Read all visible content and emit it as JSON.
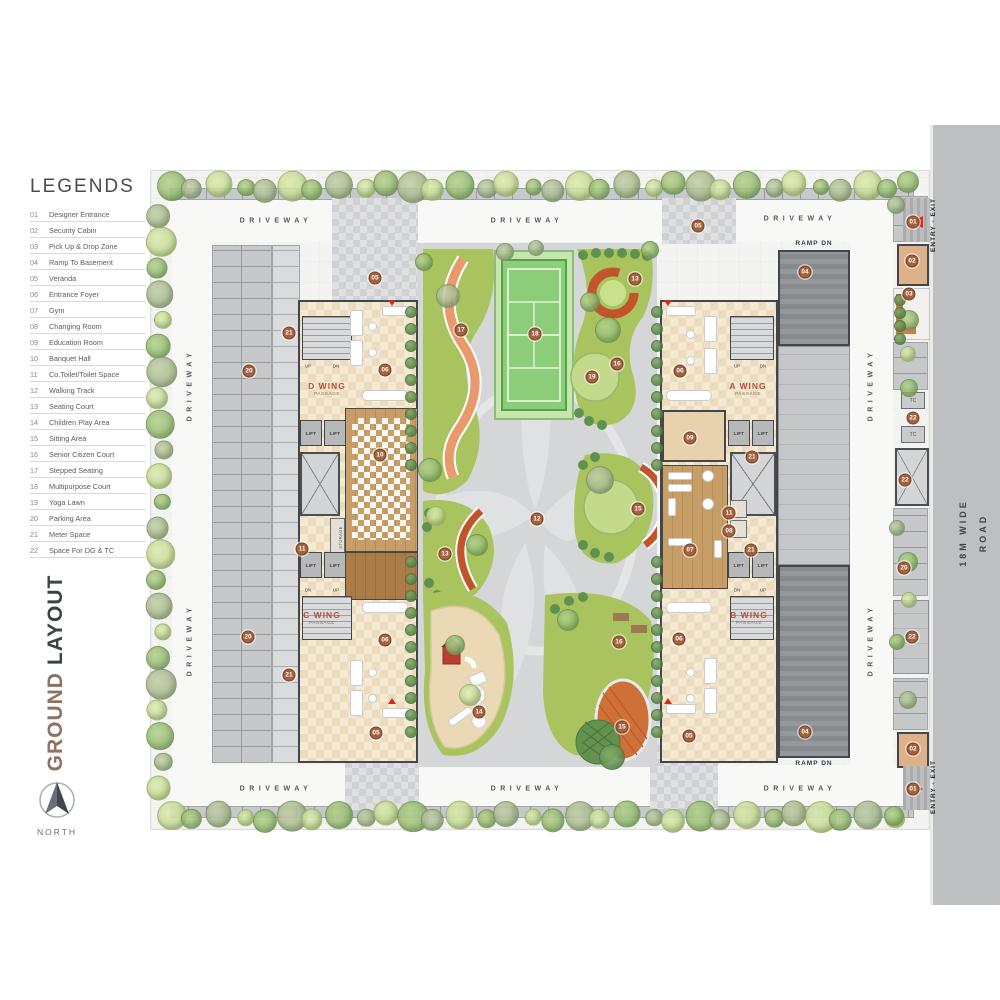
{
  "sidebar": {
    "legend_title": "LEGENDS",
    "legend_items": [
      {
        "num": "01",
        "label": "Designer Entrance"
      },
      {
        "num": "02",
        "label": "Security Cabin"
      },
      {
        "num": "03",
        "label": "Pick Up & Drop Zone"
      },
      {
        "num": "04",
        "label": "Ramp To Basement"
      },
      {
        "num": "05",
        "label": "Veranda"
      },
      {
        "num": "06",
        "label": "Entrance Foyer"
      },
      {
        "num": "07",
        "label": "Gym"
      },
      {
        "num": "08",
        "label": "Changing Room"
      },
      {
        "num": "09",
        "label": "Education Room"
      },
      {
        "num": "10",
        "label": "Banquet Hall"
      },
      {
        "num": "11",
        "label": "Co.Toilet/Toilet Space"
      },
      {
        "num": "12",
        "label": "Walking Track"
      },
      {
        "num": "13",
        "label": "Seating Court"
      },
      {
        "num": "14",
        "label": "Children Play Area"
      },
      {
        "num": "15",
        "label": "Sitting Area"
      },
      {
        "num": "16",
        "label": "Senior Citizen Court"
      },
      {
        "num": "17",
        "label": "Stepped Seating"
      },
      {
        "num": "18",
        "label": "Multipurpose Court"
      },
      {
        "num": "19",
        "label": "Yoga Lawn"
      },
      {
        "num": "20",
        "label": "Parking Area"
      },
      {
        "num": "21",
        "label": "Meter Space"
      },
      {
        "num": "22",
        "label": "Space For DG & TC"
      }
    ],
    "plan_title_primary": "GROUND",
    "plan_title_secondary": "LAYOUT",
    "north_label": "NORTH"
  },
  "road": {
    "label": "18M WIDE ROAD"
  },
  "plan": {
    "driveway_label": "DRIVEWAY",
    "ramp_label": "RAMP DN",
    "entry_exit_label": "ENTRY - EXIT",
    "lift_label": "LIFT",
    "storage_label": "STORAGE",
    "tc_label": "TC",
    "up_label": "UP",
    "dn_label": "DN",
    "wings": {
      "d": {
        "name": "D WING",
        "sub": "PASSAGE"
      },
      "a": {
        "name": "A WING",
        "sub": "PASSAGE"
      },
      "c": {
        "name": "C WING",
        "sub": "PASSAGE"
      },
      "b": {
        "name": "B WING",
        "sub": "PASSAGE"
      }
    },
    "markers": [
      {
        "n": "01",
        "x": 913,
        "y": 222
      },
      {
        "n": "02",
        "x": 912,
        "y": 261
      },
      {
        "n": "03",
        "x": 909,
        "y": 294
      },
      {
        "n": "04",
        "x": 805,
        "y": 272
      },
      {
        "n": "04",
        "x": 805,
        "y": 732
      },
      {
        "n": "05",
        "x": 375,
        "y": 278
      },
      {
        "n": "05",
        "x": 698,
        "y": 226
      },
      {
        "n": "05",
        "x": 376,
        "y": 733
      },
      {
        "n": "05",
        "x": 689,
        "y": 736
      },
      {
        "n": "06",
        "x": 385,
        "y": 370
      },
      {
        "n": "06",
        "x": 680,
        "y": 371
      },
      {
        "n": "06",
        "x": 385,
        "y": 640
      },
      {
        "n": "06",
        "x": 679,
        "y": 639
      },
      {
        "n": "07",
        "x": 690,
        "y": 550
      },
      {
        "n": "08",
        "x": 729,
        "y": 531
      },
      {
        "n": "09",
        "x": 690,
        "y": 438
      },
      {
        "n": "10",
        "x": 380,
        "y": 455
      },
      {
        "n": "11",
        "x": 302,
        "y": 549
      },
      {
        "n": "11",
        "x": 729,
        "y": 513
      },
      {
        "n": "12",
        "x": 537,
        "y": 519
      },
      {
        "n": "13",
        "x": 635,
        "y": 279
      },
      {
        "n": "13",
        "x": 445,
        "y": 554
      },
      {
        "n": "14",
        "x": 479,
        "y": 712
      },
      {
        "n": "15",
        "x": 638,
        "y": 509
      },
      {
        "n": "15",
        "x": 622,
        "y": 727
      },
      {
        "n": "16",
        "x": 617,
        "y": 364
      },
      {
        "n": "16",
        "x": 619,
        "y": 642
      },
      {
        "n": "17",
        "x": 461,
        "y": 330
      },
      {
        "n": "18",
        "x": 535,
        "y": 334
      },
      {
        "n": "19",
        "x": 592,
        "y": 377
      },
      {
        "n": "20",
        "x": 249,
        "y": 371
      },
      {
        "n": "20",
        "x": 248,
        "y": 637
      },
      {
        "n": "20",
        "x": 904,
        "y": 568
      },
      {
        "n": "21",
        "x": 289,
        "y": 333
      },
      {
        "n": "21",
        "x": 752,
        "y": 457
      },
      {
        "n": "21",
        "x": 289,
        "y": 675
      },
      {
        "n": "21",
        "x": 751,
        "y": 550
      },
      {
        "n": "22",
        "x": 913,
        "y": 418
      },
      {
        "n": "22",
        "x": 905,
        "y": 480
      },
      {
        "n": "22",
        "x": 912,
        "y": 637
      },
      {
        "n": "02",
        "x": 913,
        "y": 749
      },
      {
        "n": "01",
        "x": 913,
        "y": 789
      }
    ]
  },
  "colors": {
    "title_accent": "#8d7263",
    "title_dark": "#3e434a",
    "marker_fill": "#a5613c",
    "road_gray": "#bdbfc1",
    "court_green": "#8bcd79",
    "lawn_green": "#a9c45e",
    "seat_orange": "#e99a6d",
    "entry_red": "#dc2a1c"
  }
}
